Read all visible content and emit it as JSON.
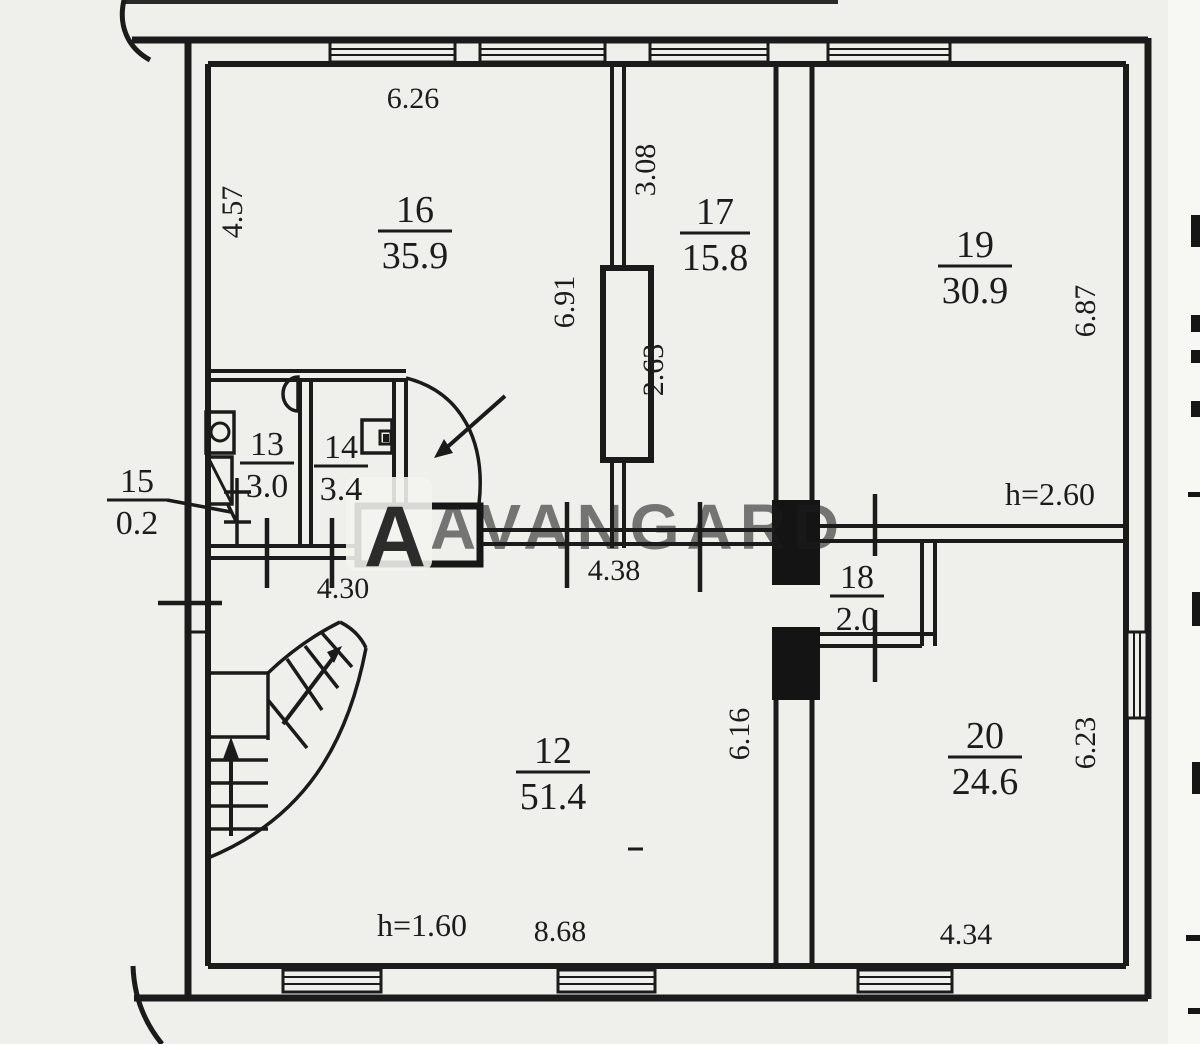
{
  "watermark": {
    "text": "AVANGARD",
    "logo_letter": "A",
    "text_color": "#8e959d",
    "logo_color": "#c9372f"
  },
  "rooms": {
    "r12": {
      "number": "12",
      "area": "51.4"
    },
    "r13": {
      "number": "13",
      "area": "3.0"
    },
    "r14": {
      "number": "14",
      "area": "3.4"
    },
    "r15": {
      "number": "15",
      "area": "0.2"
    },
    "r16": {
      "number": "16",
      "area": "35.9"
    },
    "r17": {
      "number": "17",
      "area": "15.8"
    },
    "r18": {
      "number": "18",
      "area": "2.0"
    },
    "r19": {
      "number": "19",
      "area": "30.9"
    },
    "r20": {
      "number": "20",
      "area": "24.6"
    }
  },
  "dimensions": {
    "room16_width": "6.26",
    "room16_depth": "4.57",
    "wall_16_17_upper": "3.08",
    "wall_16_17_full": "6.91",
    "flue_height": "2.63",
    "room19_depth": "6.87",
    "room19_ceiling": "h=2.60",
    "corridor_left": "4.30",
    "corridor_right": "4.38",
    "room12_right_depth": "6.16",
    "room20_depth": "6.23",
    "room12_ceiling": "h=1.60",
    "room12_width": "8.68",
    "room20_width": "4.34"
  }
}
